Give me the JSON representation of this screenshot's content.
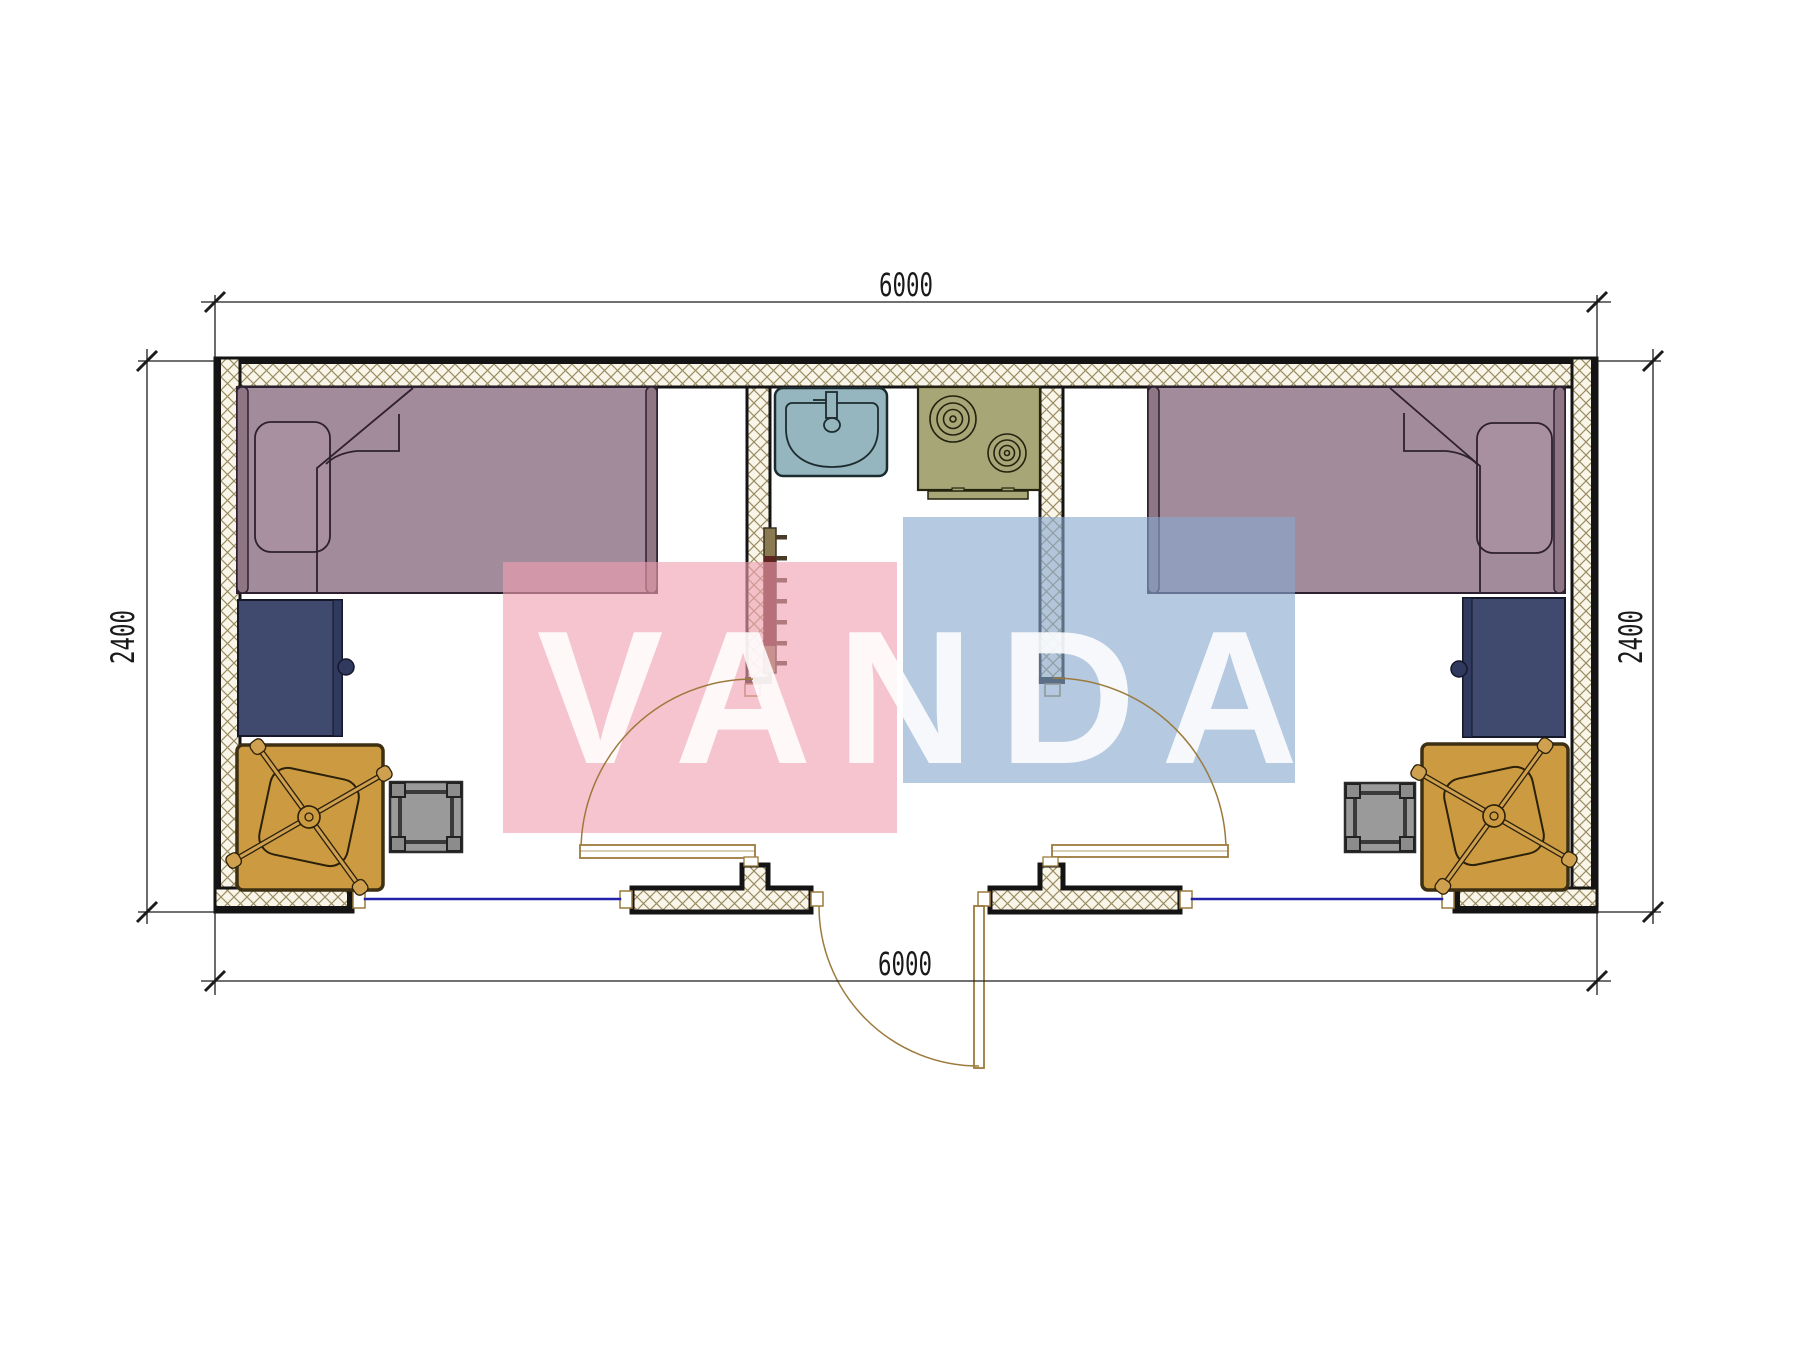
{
  "watermark": {
    "text": "VANDA",
    "pink_color": "#f3b7c6",
    "blue_color": "#b6cbe4",
    "text_color": "#ffffff"
  },
  "dimensions": {
    "top": "6000",
    "bottom": "6000",
    "left": "2400",
    "right": "2400"
  },
  "inventory": {
    "bedroom_left": [
      "single-bed",
      "pillow",
      "desk",
      "office-chair",
      "chair-mat",
      "stool"
    ],
    "kitchen_core": [
      "sink",
      "faucet",
      "stove-two-burners",
      "towel-ladder"
    ],
    "bedroom_right": [
      "single-bed",
      "pillow",
      "desk",
      "office-chair",
      "chair-mat",
      "stool"
    ],
    "openings": [
      "window-left",
      "window-right",
      "room-door-left",
      "room-door-right",
      "entry-door"
    ]
  },
  "colors": {
    "wall_hatch_line": "#998c62",
    "wall_hatch_bg": "#faf5e9",
    "wall_outline": "#141414",
    "bed": "#a28c9b",
    "bed_frame": "#8e7685",
    "desk": "#3f4a6e",
    "chair_mat": "#cc9a41",
    "stool": "#9a9a9a",
    "sink": "#95b5bf",
    "stove": "#a6a677",
    "ladder": "#8a7a52",
    "ladder_accent": "#5e2420",
    "window_glazing": "#2222aa",
    "door": "#9c7a3c",
    "dimension": "#1c1c1c"
  }
}
